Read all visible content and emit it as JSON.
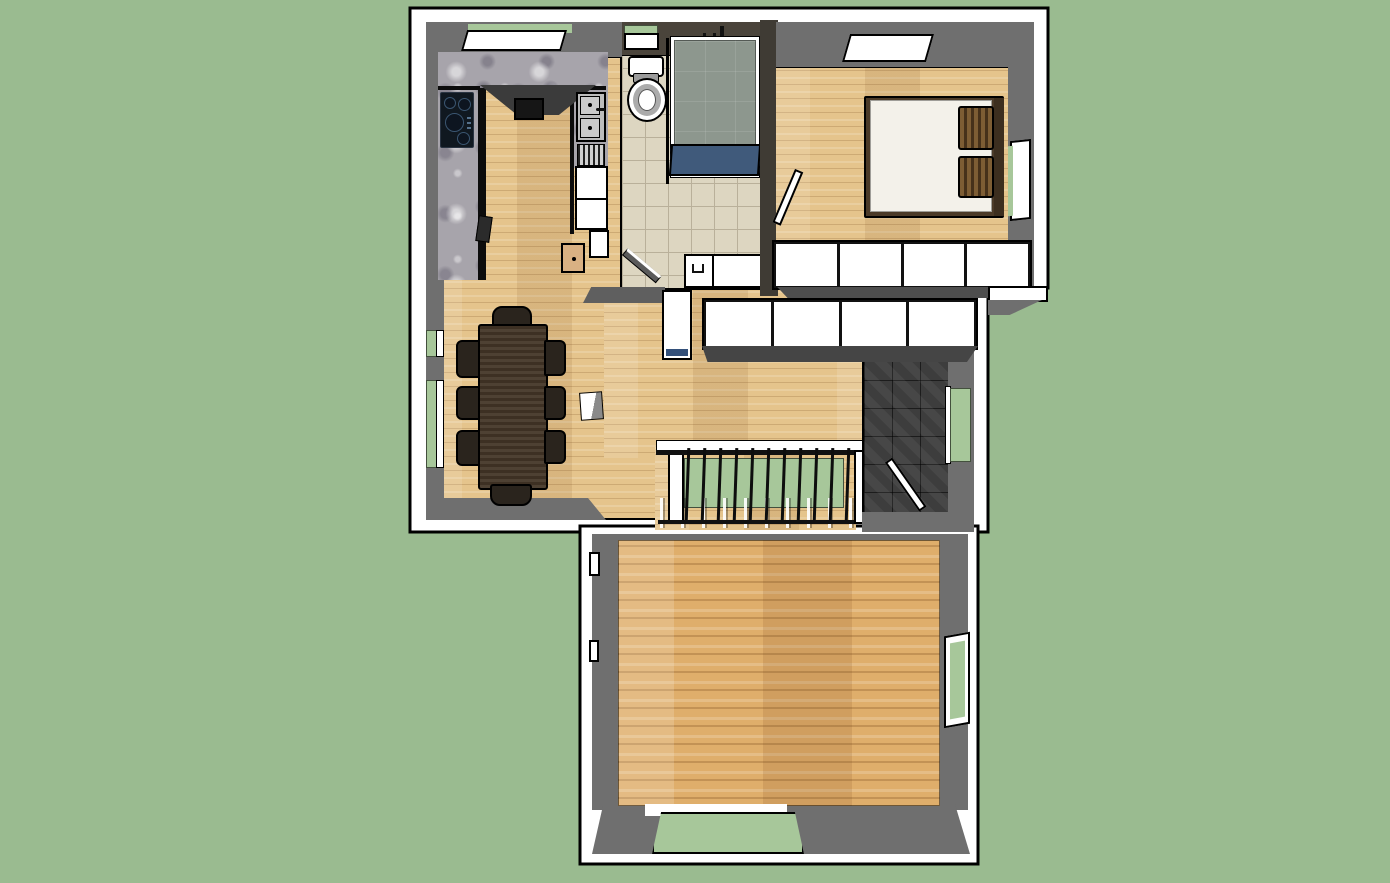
{
  "scene": {
    "description": "SketchUp-style 3D top-down render of a small apartment floor plan on a plain green ground, no visible text or UI chrome",
    "view": "orthographic top view with slight perspective on wall faces",
    "colors": {
      "bg-green": "#9abb90",
      "sill-green": "#a7c79a",
      "wall-white": "#ffffff",
      "line-black": "#000000",
      "wall-gray": "#6f6f6f",
      "wall-gray-dark": "#4e4e4e",
      "bath-wall-brown": "#4a443b",
      "tile-beige": "#ddd6c1",
      "tile-grout": "#b9b09a",
      "entry-tile": "#3d3d3d",
      "granite-gray": "#a7a4ab",
      "wood-base": "#e5c48c",
      "wood2-base": "#dfae6b",
      "shower-tile": "#8d978e",
      "tub-blue": "#405a7b",
      "cabinet-blue": "#33507a",
      "bed-frame-brown": "#4b3a28",
      "mattress-white": "#f3f1ea",
      "pillow-light": "#7d5d34",
      "pillow-dark": "#46311a",
      "table-brown": "#453728",
      "chair-brown": "#2a241d",
      "cabinet-tan": "#d9b183",
      "steel-gray": "#bcbcbc",
      "cooktop-black": "#101820"
    },
    "rooms": [
      {
        "name": "kitchen",
        "floor": "light wood plank",
        "features": [
          "U-shaped granite counter",
          "black 4-burner cooktop",
          "range hood",
          "stainless double sink with faucet",
          "ribbed drainboard",
          "white under-sink cabinet",
          "small tan cabinet"
        ]
      },
      {
        "name": "bathroom",
        "floor": "beige ceramic tile grid",
        "features": [
          "toilet",
          "walk-in shower with glass panel",
          "blue tub front panel",
          "overhead shower fixture",
          "white vanity",
          "window with green sill",
          "inward swinging door"
        ]
      },
      {
        "name": "bedroom",
        "floor": "light wood plank",
        "features": [
          "double bed with white mattress",
          "two brown striped pillows",
          "dark bed frame with headboard",
          "skylight in top wall",
          "window with green sill",
          "closet row of 4 white doors",
          "inward swinging door"
        ]
      },
      {
        "name": "dining-room",
        "floor": "light wood plank",
        "features": [
          "dark rectangular table",
          "8 dark chairs",
          "two windows with green sills",
          "small white pedestal cube"
        ]
      },
      {
        "name": "hallway",
        "floor": "light wood plank",
        "features": [
          "closet row of 4 white doors",
          "tall white cabinet with blue base"
        ]
      },
      {
        "name": "entry",
        "floor": "dark slate tile",
        "features": [
          "front door ajar",
          "window with green sill"
        ]
      },
      {
        "name": "stairwell",
        "floor": "wood with green landing below",
        "features": [
          "black railing with balusters",
          "white newel posts",
          "stair treads"
        ]
      },
      {
        "name": "lower-room",
        "floor": "orange wood plank",
        "features": [
          "empty room",
          "window with green sill on right wall",
          "wide floor opening to ground at bottom",
          "two small wall notches on left"
        ]
      }
    ],
    "counts": {
      "dining_chairs": 8,
      "bedroom_closet_doors": 4,
      "hallway_closet_doors": 4,
      "stair_balusters": 11,
      "cooktop_burners": 4,
      "sink_basins": 2,
      "windows_total": 8
    }
  }
}
